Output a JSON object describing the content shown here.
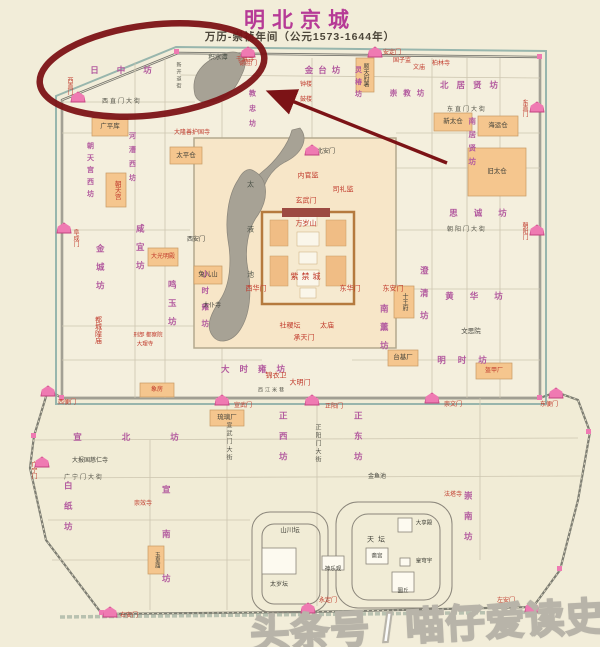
{
  "header": {
    "title": "明北京城",
    "subtitle": "万历-崇祯年间（公元1573-1644年）"
  },
  "watermark": {
    "text": "头条号 / 喵仔爱读史"
  },
  "colors": {
    "title_magenta": "#b63a96",
    "annotation_red": "#7c1316",
    "ward_purple": "#b2599e",
    "landmark_red": "#c0392b",
    "gate_pink": "#ef7ab2",
    "lake_gray": "#a7a295",
    "building_orange": "#f5c68e",
    "paper_cream": "#f2edd9"
  },
  "map": {
    "labels": [
      {
        "t": "日中坊",
        "x": 130,
        "y": 70,
        "c": "ward",
        "ls": 18
      },
      {
        "t": "金台坊",
        "x": 325,
        "y": 70,
        "c": "ward",
        "ls": 5
      },
      {
        "t": "灵椿坊",
        "x": 358,
        "y": 84,
        "c": "ward",
        "v": 1,
        "ls": 5,
        "fs": 7
      },
      {
        "t": "崇教坊",
        "x": 410,
        "y": 93,
        "c": "ward",
        "ls": 6,
        "fs": 7.5
      },
      {
        "t": "北居贤坊",
        "x": 473,
        "y": 85,
        "c": "ward",
        "ls": 8
      },
      {
        "t": "教忠坊",
        "x": 252,
        "y": 112,
        "c": "ward",
        "v": 1,
        "ls": 8,
        "fs": 7
      },
      {
        "t": "南居贤坊",
        "x": 472,
        "y": 144,
        "c": "ward",
        "v": 1,
        "ls": 6,
        "fs": 7.5
      },
      {
        "t": "思诚坊",
        "x": 486,
        "y": 213,
        "c": "ward",
        "ls": 16
      },
      {
        "t": "黄华坊",
        "x": 482,
        "y": 296,
        "c": "ward",
        "ls": 16
      },
      {
        "t": "澄清坊",
        "x": 424,
        "y": 300,
        "c": "ward",
        "v": 1,
        "ls": 14
      },
      {
        "t": "明时坊",
        "x": 468,
        "y": 360,
        "c": "ward",
        "ls": 12
      },
      {
        "t": "南薰坊",
        "x": 384,
        "y": 332,
        "c": "ward",
        "v": 1,
        "ls": 10
      },
      {
        "t": "大时雍坊",
        "x": 258,
        "y": 369,
        "c": "ward",
        "ls": 10
      },
      {
        "t": "小时雍坊",
        "x": 205,
        "y": 303,
        "c": "ward",
        "v": 1,
        "ls": 9,
        "fs": 7.5
      },
      {
        "t": "鸣玉坊",
        "x": 172,
        "y": 308,
        "c": "ward",
        "v": 1,
        "ls": 10
      },
      {
        "t": "咸宜坊",
        "x": 140,
        "y": 252,
        "c": "ward",
        "v": 1,
        "ls": 10
      },
      {
        "t": "金城坊",
        "x": 100,
        "y": 272,
        "c": "ward",
        "v": 1,
        "ls": 10
      },
      {
        "t": "朝天宫西坊",
        "x": 90,
        "y": 172,
        "c": "ward",
        "v": 1,
        "ls": 5,
        "fs": 7
      },
      {
        "t": "河漕西坊",
        "x": 132,
        "y": 160,
        "c": "ward",
        "v": 1,
        "ls": 7,
        "fs": 7
      },
      {
        "t": "宣北坊",
        "x": 146,
        "y": 437,
        "c": "ward",
        "ls": 40
      },
      {
        "t": "宣南坊",
        "x": 166,
        "y": 552,
        "c": "ward",
        "v": 1,
        "ls": 36
      },
      {
        "t": "白纸坊",
        "x": 68,
        "y": 512,
        "c": "ward",
        "v": 1,
        "ls": 12
      },
      {
        "t": "正西坊",
        "x": 283,
        "y": 442,
        "c": "ward",
        "v": 1,
        "ls": 12
      },
      {
        "t": "正东坊",
        "x": 358,
        "y": 442,
        "c": "ward",
        "v": 1,
        "ls": 12
      },
      {
        "t": "崇南坊",
        "x": 468,
        "y": 522,
        "c": "ward",
        "v": 1,
        "ls": 12
      },
      {
        "t": "紫禁城",
        "x": 307,
        "y": 277,
        "c": "red",
        "fs": 8,
        "ls": 3
      },
      {
        "t": "万岁山",
        "x": 306,
        "y": 224,
        "c": "red"
      },
      {
        "t": "玄武门",
        "x": 306,
        "y": 201,
        "c": "red"
      },
      {
        "t": "内官监",
        "x": 308,
        "y": 176,
        "c": "red"
      },
      {
        "t": "司礼监",
        "x": 343,
        "y": 190,
        "c": "red"
      },
      {
        "t": "西华门",
        "x": 256,
        "y": 289,
        "c": "red"
      },
      {
        "t": "东华门",
        "x": 350,
        "y": 289,
        "c": "red"
      },
      {
        "t": "东安门",
        "x": 393,
        "y": 289,
        "c": "red"
      },
      {
        "t": "承天门",
        "x": 304,
        "y": 338,
        "c": "red"
      },
      {
        "t": "大明门",
        "x": 300,
        "y": 383,
        "c": "red"
      },
      {
        "t": "锦衣卫",
        "x": 276,
        "y": 376,
        "c": "red"
      },
      {
        "t": "社稷坛",
        "x": 290,
        "y": 326,
        "c": "red"
      },
      {
        "t": "太庙",
        "x": 327,
        "y": 326,
        "c": "red"
      },
      {
        "t": "都城隍庙",
        "x": 98,
        "y": 330,
        "c": "red",
        "v": 1
      },
      {
        "t": "大隆善护国寺",
        "x": 192,
        "y": 133,
        "c": "red",
        "fs": 6
      },
      {
        "t": "千佛寺",
        "x": 245,
        "y": 60,
        "c": "red",
        "fs": 6
      },
      {
        "t": "钟楼",
        "x": 306,
        "y": 85,
        "c": "red",
        "fs": 6
      },
      {
        "t": "鼓楼",
        "x": 306,
        "y": 100,
        "c": "red",
        "fs": 6
      },
      {
        "t": "国子监",
        "x": 402,
        "y": 61,
        "c": "red",
        "fs": 6
      },
      {
        "t": "文庙",
        "x": 419,
        "y": 68,
        "c": "red",
        "fs": 6
      },
      {
        "t": "柏林寺",
        "x": 441,
        "y": 64,
        "c": "red",
        "fs": 6
      },
      {
        "t": "崇效寺",
        "x": 143,
        "y": 504,
        "c": "red",
        "fs": 6
      },
      {
        "t": "法塔寺",
        "x": 453,
        "y": 495,
        "c": "red",
        "fs": 6
      },
      {
        "t": "大光明殿",
        "x": 163,
        "y": 257,
        "c": "red",
        "fs": 6
      },
      {
        "t": "盔甲厂",
        "x": 494,
        "y": 371,
        "c": "red",
        "fs": 6
      },
      {
        "t": "朝天宫",
        "x": 116,
        "y": 190,
        "c": "red",
        "v": 1,
        "fs": 6.5
      },
      {
        "t": "刑部 都察院",
        "x": 148,
        "y": 336,
        "c": "red",
        "fs": 5.5
      },
      {
        "t": "大理寺",
        "x": 145,
        "y": 345,
        "c": "red",
        "fs": 5.5
      },
      {
        "t": "象房",
        "x": 157,
        "y": 390,
        "c": "red",
        "fs": 6
      },
      {
        "t": "积水潭",
        "x": 218,
        "y": 58,
        "c": "lake",
        "fs": 6.5
      },
      {
        "t": "太液池",
        "x": 250,
        "y": 248,
        "c": "lake",
        "v": 1,
        "ls": 38
      },
      {
        "t": "广平库",
        "x": 110,
        "y": 127,
        "c": "blk",
        "fs": 6.5
      },
      {
        "t": "太平仓",
        "x": 186,
        "y": 156,
        "c": "blk",
        "fs": 6.5
      },
      {
        "t": "兔儿山",
        "x": 208,
        "y": 275,
        "c": "blk",
        "fs": 6.5
      },
      {
        "t": "西安门",
        "x": 196,
        "y": 240,
        "c": "blk",
        "fs": 6
      },
      {
        "t": "北安门",
        "x": 326,
        "y": 152,
        "c": "blk",
        "fs": 6
      },
      {
        "t": "太仆寺",
        "x": 212,
        "y": 306,
        "c": "blk",
        "fs": 6
      },
      {
        "t": "旧太仓",
        "x": 497,
        "y": 172,
        "c": "blk",
        "fs": 6.5
      },
      {
        "t": "新太仓",
        "x": 453,
        "y": 122,
        "c": "blk",
        "fs": 6.5
      },
      {
        "t": "海运仓",
        "x": 498,
        "y": 126,
        "c": "blk",
        "fs": 6.5
      },
      {
        "t": "十王府",
        "x": 404,
        "y": 302,
        "c": "blk",
        "v": 1,
        "fs": 6
      },
      {
        "t": "文思院",
        "x": 471,
        "y": 332,
        "c": "blk",
        "fs": 6.5
      },
      {
        "t": "台基厂",
        "x": 403,
        "y": 358,
        "c": "blk",
        "fs": 6.5
      },
      {
        "t": "顺天府署",
        "x": 365,
        "y": 75,
        "c": "blk",
        "v": 1,
        "fs": 6
      },
      {
        "t": "琉璃厂",
        "x": 227,
        "y": 418,
        "c": "blk",
        "fs": 6.5
      },
      {
        "t": "大报国慈仁寺",
        "x": 90,
        "y": 461,
        "c": "blk",
        "fs": 6
      },
      {
        "t": "山川坛",
        "x": 290,
        "y": 531,
        "c": "blk",
        "fs": 6.5
      },
      {
        "t": "太岁坛",
        "x": 279,
        "y": 585,
        "c": "blk",
        "fs": 6
      },
      {
        "t": "天坛",
        "x": 378,
        "y": 540,
        "c": "blk",
        "fs": 7,
        "ls": 4
      },
      {
        "t": "斋宫",
        "x": 377,
        "y": 557,
        "c": "blk",
        "fs": 5.5
      },
      {
        "t": "大享殿",
        "x": 424,
        "y": 524,
        "c": "blk",
        "fs": 5.5
      },
      {
        "t": "皇穹宇",
        "x": 424,
        "y": 562,
        "c": "blk",
        "fs": 5.5
      },
      {
        "t": "圜丘",
        "x": 403,
        "y": 592,
        "c": "blk",
        "fs": 5.5
      },
      {
        "t": "神乐观",
        "x": 333,
        "y": 570,
        "c": "blk",
        "fs": 5.5
      },
      {
        "t": "玉皇庙",
        "x": 156,
        "y": 560,
        "c": "blk",
        "v": 1,
        "fs": 5.5
      },
      {
        "t": "金鱼池",
        "x": 377,
        "y": 477,
        "c": "blk",
        "fs": 6
      },
      {
        "t": "西直门大街",
        "x": 122,
        "y": 102,
        "c": "street"
      },
      {
        "t": "东直门大街",
        "x": 467,
        "y": 110,
        "c": "street"
      },
      {
        "t": "朝阳门大街",
        "x": 467,
        "y": 230,
        "c": "street"
      },
      {
        "t": "正阳门大街",
        "x": 317,
        "y": 444,
        "c": "street",
        "v": 1
      },
      {
        "t": "宣武门大街",
        "x": 228,
        "y": 442,
        "c": "street",
        "v": 1
      },
      {
        "t": "广宁门大街",
        "x": 84,
        "y": 478,
        "c": "street"
      },
      {
        "t": "西江米巷",
        "x": 272,
        "y": 391,
        "c": "street",
        "fs": 5
      },
      {
        "t": "新开道街",
        "x": 178,
        "y": 76,
        "c": "street",
        "v": 1,
        "fs": 5
      },
      {
        "t": "德胜门",
        "x": 248,
        "y": 64,
        "c": "red",
        "fs": 6
      },
      {
        "t": "安定门",
        "x": 392,
        "y": 53,
        "c": "red",
        "fs": 6
      },
      {
        "t": "西直门",
        "x": 69,
        "y": 86,
        "c": "red",
        "v": 1,
        "fs": 6
      },
      {
        "t": "阜成门",
        "x": 75,
        "y": 238,
        "c": "red",
        "v": 1,
        "fs": 6
      },
      {
        "t": "宣武门",
        "x": 243,
        "y": 406,
        "c": "red",
        "fs": 6
      },
      {
        "t": "正阳门",
        "x": 334,
        "y": 407,
        "c": "red",
        "fs": 6
      },
      {
        "t": "崇文门",
        "x": 453,
        "y": 405,
        "c": "red",
        "fs": 6
      },
      {
        "t": "东直门",
        "x": 524,
        "y": 108,
        "c": "red",
        "v": 1,
        "fs": 6
      },
      {
        "t": "朝阳门",
        "x": 524,
        "y": 231,
        "c": "red",
        "v": 1,
        "fs": 6
      },
      {
        "t": "西便门",
        "x": 67,
        "y": 403,
        "c": "red",
        "fs": 6
      },
      {
        "t": "广宁门",
        "x": 33,
        "y": 470,
        "c": "red",
        "v": 1,
        "fs": 6
      },
      {
        "t": "右安门",
        "x": 129,
        "y": 616,
        "c": "red",
        "fs": 6
      },
      {
        "t": "永定门",
        "x": 328,
        "y": 601,
        "c": "red",
        "fs": 6
      },
      {
        "t": "左安门",
        "x": 506,
        "y": 601,
        "c": "red",
        "fs": 6
      },
      {
        "t": "东便门",
        "x": 549,
        "y": 405,
        "c": "red",
        "fs": 6
      }
    ],
    "gates": [
      {
        "n": "deshengmen",
        "x": 248,
        "y": 52
      },
      {
        "n": "andingmen",
        "x": 375,
        "y": 52
      },
      {
        "n": "xizhimen",
        "x": 78,
        "y": 97
      },
      {
        "n": "fuchengmen",
        "x": 64,
        "y": 228
      },
      {
        "n": "xuanwumen",
        "x": 222,
        "y": 400
      },
      {
        "n": "zhengyangmen",
        "x": 312,
        "y": 400
      },
      {
        "n": "chongwenmen",
        "x": 432,
        "y": 398
      },
      {
        "n": "dongzhimen",
        "x": 537,
        "y": 107
      },
      {
        "n": "chaoyangmen",
        "x": 537,
        "y": 230
      },
      {
        "n": "xibianmen",
        "x": 48,
        "y": 391
      },
      {
        "n": "guangningmen",
        "x": 42,
        "y": 462
      },
      {
        "n": "youanmen",
        "x": 110,
        "y": 612
      },
      {
        "n": "yongdingmen",
        "x": 308,
        "y": 608
      },
      {
        "n": "zuoanmen",
        "x": 532,
        "y": 607
      },
      {
        "n": "dongbianmen",
        "x": 556,
        "y": 393
      },
      {
        "n": "beianmen",
        "x": 312,
        "y": 150
      }
    ]
  }
}
